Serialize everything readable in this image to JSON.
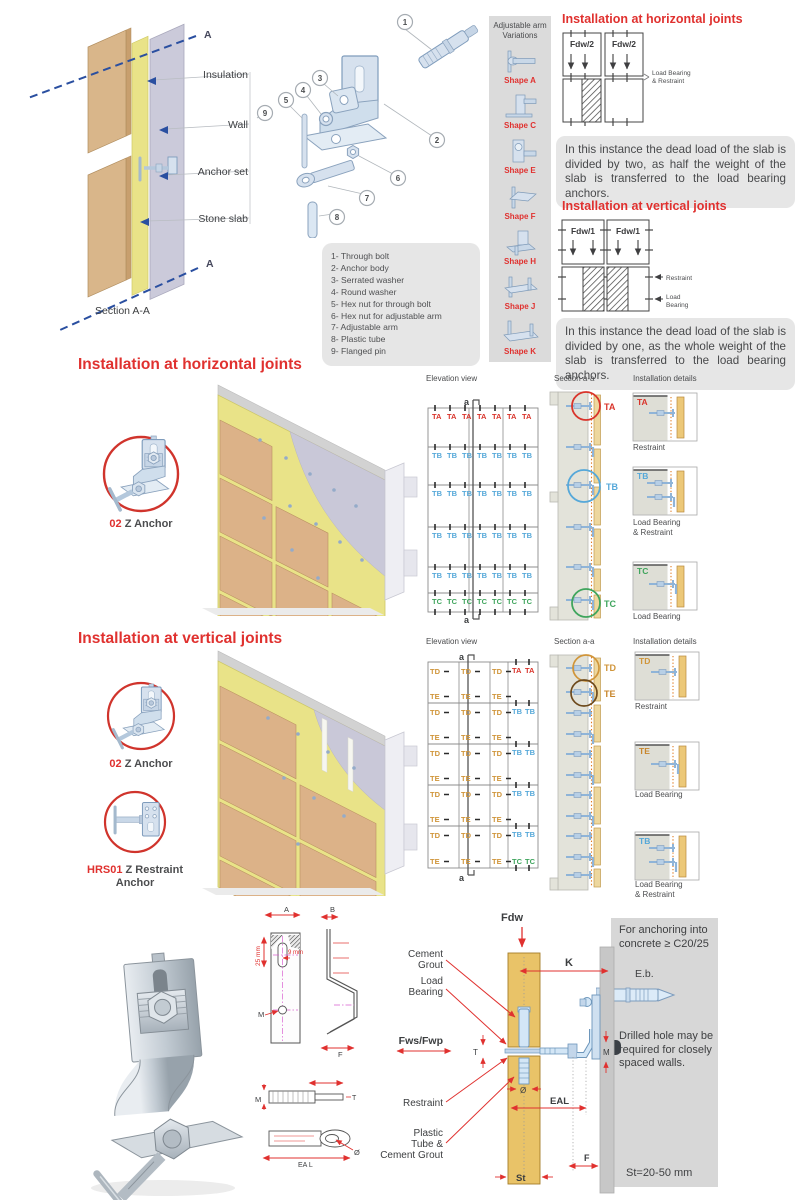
{
  "palette": {
    "red": "#e0312f",
    "dark": "#46484a",
    "blue": "#56a8d9",
    "green": "#3fa55d",
    "orange": "#d0953a",
    "brown": "#c8862c",
    "steel": "#d6e1ee",
    "steel_stroke": "#7f9cbc",
    "stone": "#dcb288",
    "insulation": "#e9e388",
    "wall": "#c9c8d8",
    "panel_gray": "#d7d7d7",
    "box_gray": "#e6e6e6"
  },
  "section_a": {
    "marker_top": "A",
    "marker_bottom": "A",
    "caption": "Section A-A",
    "labels": {
      "insulation": "Insulation",
      "wall": "Wall",
      "anchor_set": "Anchor set",
      "stone_slab": "Stone slab"
    }
  },
  "exploded": {
    "numbers": [
      "1",
      "2",
      "3",
      "4",
      "5",
      "6",
      "7",
      "8",
      "9"
    ]
  },
  "parts_list": [
    "1- Through bolt",
    "2- Anchor body",
    "3- Serrated washer",
    "4- Round washer",
    "5- Hex nut for through bolt",
    "6- Hex nut for adjustable arm",
    "7- Adjustable arm",
    "8- Plastic tube",
    "9- Flanged pin"
  ],
  "arm_variations": {
    "title_line1": "Adjustable arm",
    "title_line2": "Variations",
    "shapes": [
      "Shape A",
      "Shape C",
      "Shape E",
      "Shape F",
      "Shape H",
      "Shape J",
      "Shape K"
    ]
  },
  "joint_info": {
    "horizontal": {
      "title": "Installation at horizontal joints",
      "force": "Fdw/2",
      "annotation_line1": "Load Bearing",
      "annotation_line2": "& Restraint",
      "body": "In this instance the dead load of the slab is divided by two, as half the weight of the slab is transferred to the load bearing anchors."
    },
    "vertical": {
      "title": "Installation at vertical joints",
      "force": "Fdw/1",
      "annotation_restraint": "Restraint",
      "annotation_load_line1": "Load",
      "annotation_load_line2": "Bearing",
      "body": "In this instance the dead load of the slab is divided by one, as the whole weight of the slab is transferred to the load bearing anchors."
    }
  },
  "horizontal_section": {
    "title": "Installation at horizontal joints",
    "anchor_code": "02",
    "anchor_name": "Z Anchor",
    "elevation_title": "Elevation view",
    "section_title": "Section a-a",
    "details_title": "Installation details",
    "marker": "a",
    "section_tags": {
      "ta": "TA",
      "tb": "TB",
      "tc": "TC"
    },
    "details": [
      {
        "tag": "TA",
        "caption_line1": "Restraint",
        "caption_line2": ""
      },
      {
        "tag": "TB",
        "caption_line1": "Load Bearing",
        "caption_line2": "& Restraint"
      },
      {
        "tag": "TC",
        "caption_line1": "Load Bearing",
        "caption_line2": ""
      }
    ]
  },
  "vertical_section": {
    "title": "Installation at vertical joints",
    "anchor1_code": "02",
    "anchor1_name": "Z Anchor",
    "anchor2_code": "HRS01",
    "anchor2_name_line1": "Z Restraint",
    "anchor2_name_line2": "Anchor",
    "elevation_title": "Elevation view",
    "section_title": "Section a-a",
    "details_title": "Installation details",
    "marker": "a",
    "section_tags": {
      "td": "TD",
      "te": "TE"
    },
    "details": [
      {
        "tag": "TD",
        "caption_line1": "Restraint",
        "caption_line2": ""
      },
      {
        "tag": "TE",
        "caption_line1": "Load Bearing",
        "caption_line2": ""
      },
      {
        "tag": "TB",
        "caption_line1": "Load Bearing",
        "caption_line2": "& Restraint"
      }
    ]
  },
  "elevation_h": {
    "cols": 7,
    "rows": [
      {
        "tag": "TA",
        "color": "#d9342b"
      },
      {
        "tag": "TB",
        "color": "#56a8d9"
      },
      {
        "tag": "TB",
        "color": "#56a8d9"
      },
      {
        "tag": "TB",
        "color": "#56a8d9"
      },
      {
        "tag": "TB",
        "color": "#56a8d9"
      },
      {
        "tag": "TC",
        "color": "#3fa55d"
      }
    ]
  },
  "elevation_v": {
    "rows": 5,
    "left_cols": 3,
    "cell_top_tag": "TD",
    "cell_bottom_tag": "TE",
    "cell_color": "#d0953a",
    "right_rows": [
      {
        "top": "TA",
        "topColor": "#d9342b",
        "bottom": ""
      },
      {
        "top": "TB",
        "topColor": "#56a8d9",
        "bottom": ""
      },
      {
        "top": "TB",
        "topColor": "#56a8d9",
        "bottom": ""
      },
      {
        "top": "TB",
        "topColor": "#56a8d9",
        "bottom": ""
      },
      {
        "top": "TB",
        "topColor": "#56a8d9",
        "bottom": "TC",
        "bottomColor": "#3fa55d"
      }
    ]
  },
  "bottom": {
    "drawings": {
      "dim_a": "A",
      "dim_b": "B",
      "dim_f": "F",
      "dim_m_front": "M",
      "dim_25": "25 mm",
      "dim_9": "9 mm",
      "dim_m_bolt": "M",
      "dim_t_bolt": "T",
      "dim_ea_l": "EA  L",
      "dim_dia": "Ø"
    },
    "diagram": {
      "fdw": "Fdw",
      "k": "K",
      "m": "M",
      "t": "T",
      "dia": "Ø",
      "eal": "EAL",
      "f": "F",
      "st": "St",
      "fws": "Fws/Fwp",
      "cement_line1": "Cement",
      "cement_line2": "Grout",
      "load_line1": "Load",
      "load_line2": "Bearing",
      "restraint": "Restraint",
      "plastic_line1": "Plastic",
      "plastic_line2": "Tube &",
      "plastic_line3": "Cement Grout"
    },
    "panel": {
      "heading_line1": "For anchoring into",
      "heading_line2": "concrete ≥ C20/25",
      "eb": "E.b.",
      "note": "Drilled hole may be required for closely spaced walls.",
      "st_range": "St=20-50 mm"
    }
  }
}
